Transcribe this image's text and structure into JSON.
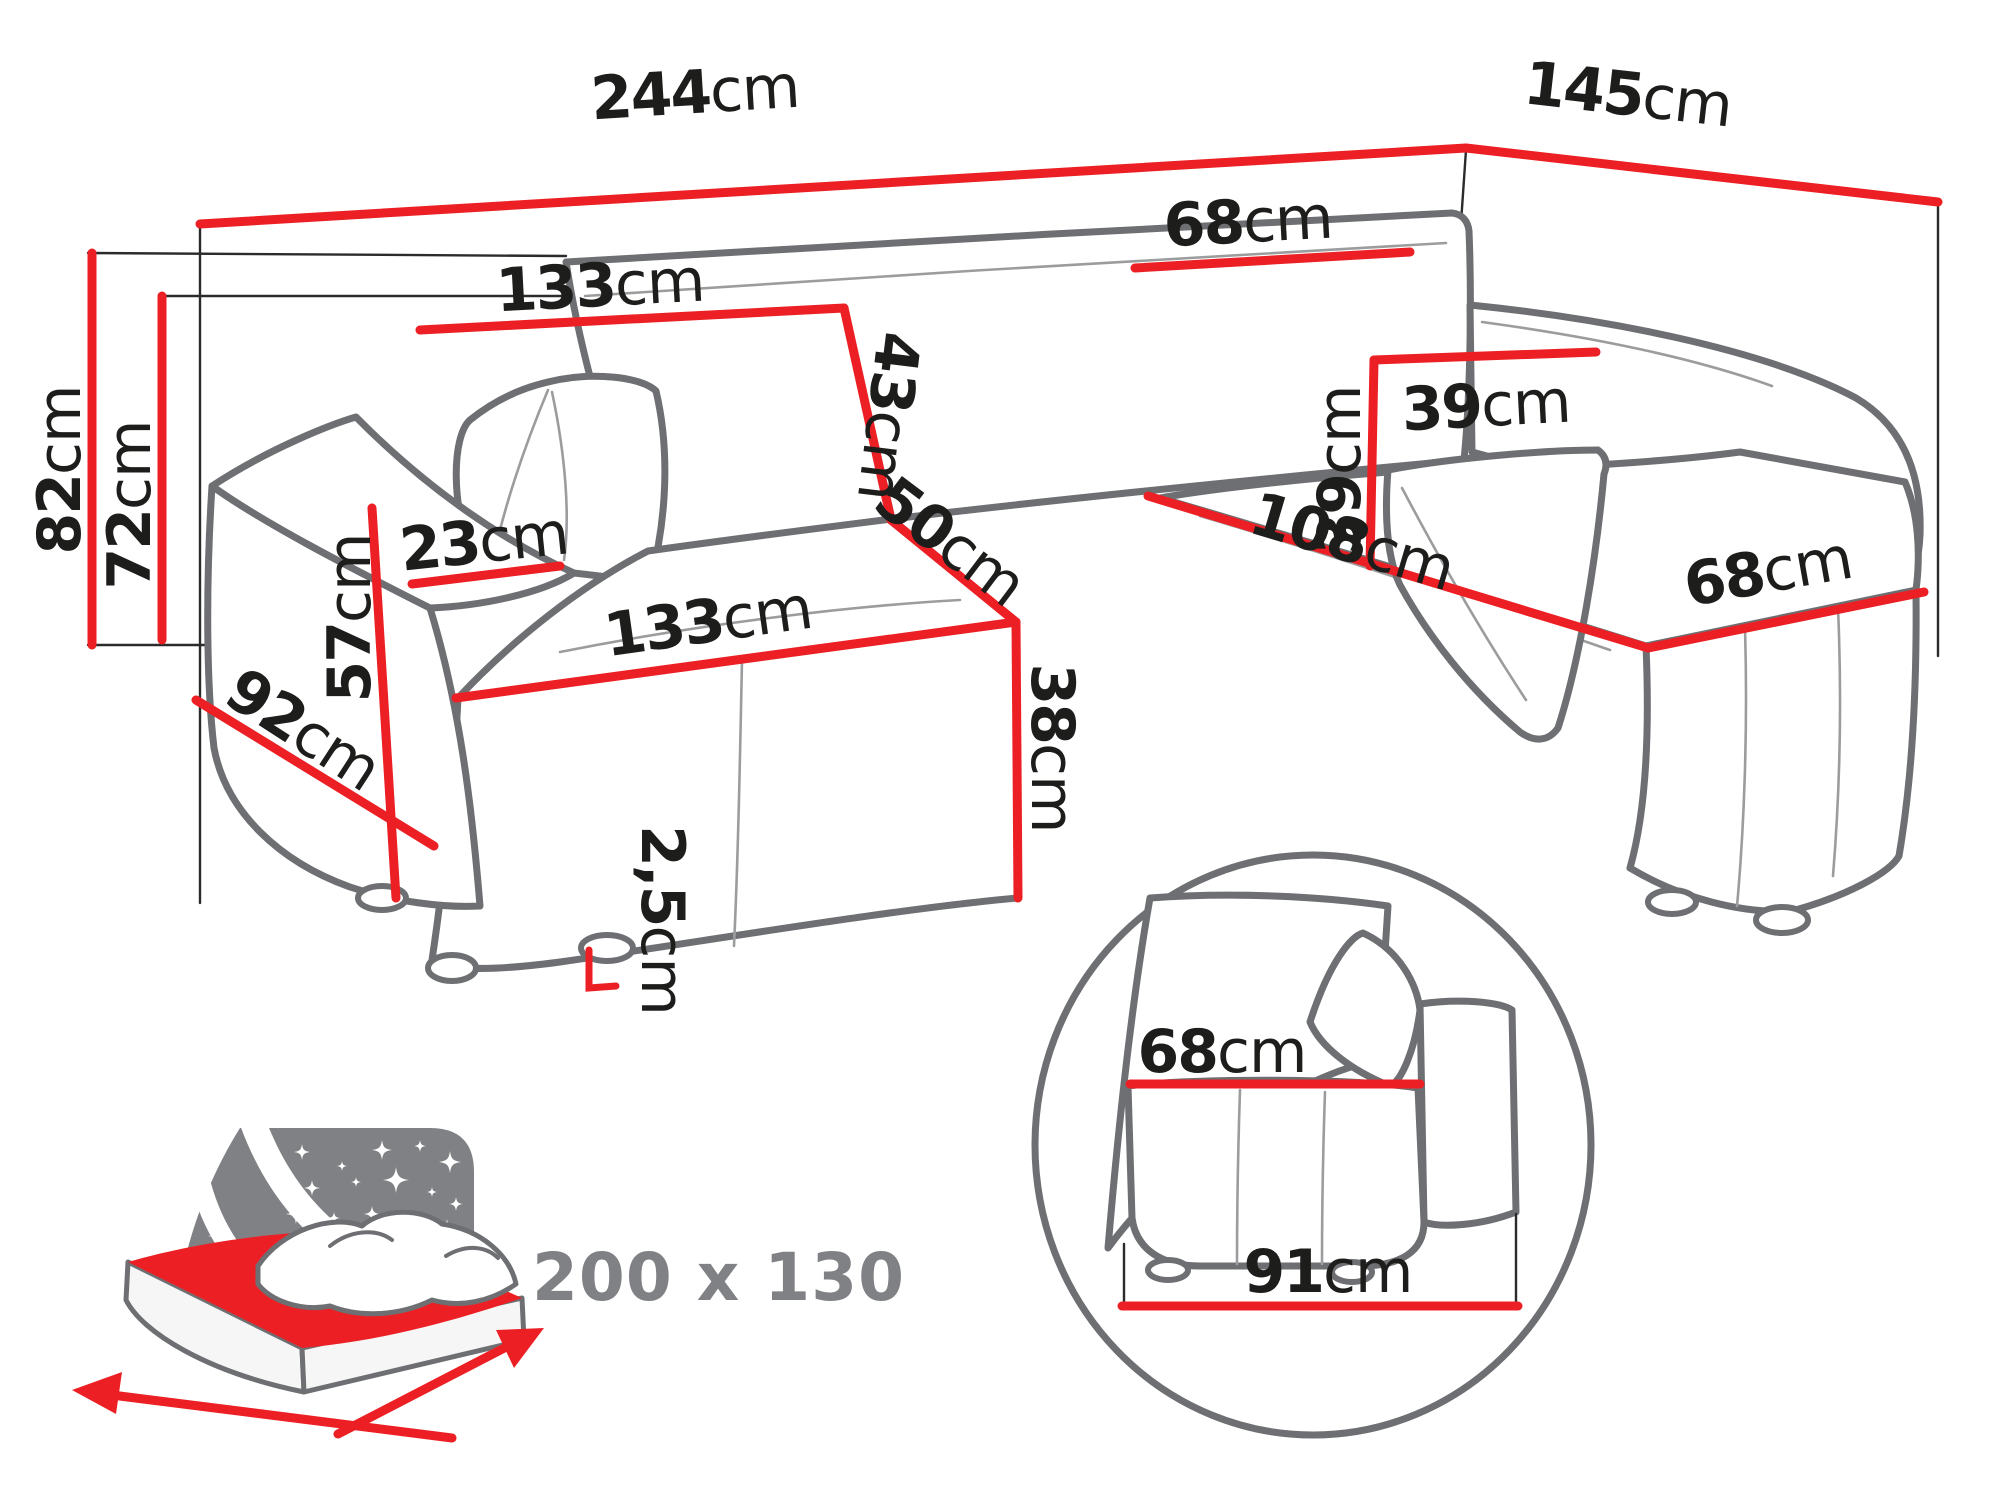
{
  "title": "Corner sofa bed dimensions diagram",
  "colors": {
    "dimension_red": "#ec2024",
    "outline_gray": "#6e6f72",
    "icon_gray": "#808184",
    "text_black": "#1d1d1b"
  },
  "dimensions": {
    "total_width": {
      "value": "244",
      "unit": "cm"
    },
    "total_depth": {
      "value": "145",
      "unit": "cm"
    },
    "total_height": {
      "value": "82",
      "unit": "cm"
    },
    "frame_height": {
      "value": "72",
      "unit": "cm"
    },
    "backrest_section_width": {
      "value": "133",
      "unit": "cm"
    },
    "corner_backrest_width": {
      "value": "68",
      "unit": "cm"
    },
    "backrest_height": {
      "value": "43",
      "unit": "cm"
    },
    "corner_seat_depth": {
      "value": "50",
      "unit": "cm"
    },
    "seat_width": {
      "value": "133",
      "unit": "cm"
    },
    "seat_height": {
      "value": "38",
      "unit": "cm"
    },
    "armrest_width": {
      "value": "23",
      "unit": "cm"
    },
    "armrest_height": {
      "value": "57",
      "unit": "cm"
    },
    "side_depth": {
      "value": "92",
      "unit": "cm"
    },
    "cushion_width": {
      "value": "39",
      "unit": "cm"
    },
    "cushion_height": {
      "value": "39",
      "unit": "cm"
    },
    "chaise_length": {
      "value": "108",
      "unit": "cm"
    },
    "chaise_width": {
      "value": "68",
      "unit": "cm"
    },
    "leg_height": {
      "value": "2,5",
      "unit": "cm"
    }
  },
  "detail_view": {
    "armrest_module_depth": {
      "value": "68",
      "unit": "cm"
    },
    "base_depth": {
      "value": "91",
      "unit": "cm"
    }
  },
  "sleeping_area": {
    "size_label": "200 x 130"
  }
}
